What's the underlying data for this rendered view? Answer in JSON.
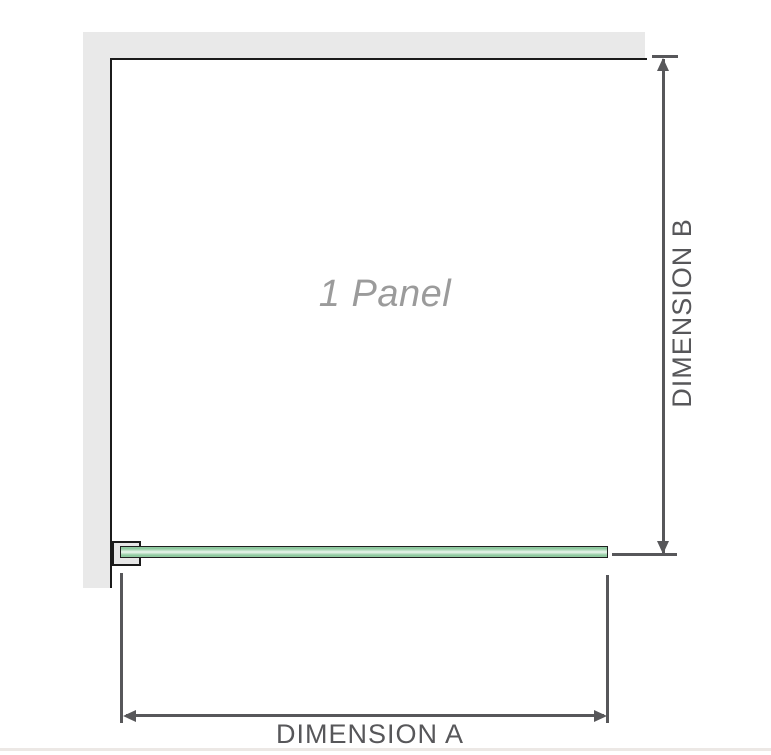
{
  "diagram": {
    "panel_label": "1 Panel",
    "dimension_a_label": "DIMENSION A",
    "dimension_b_label": "DIMENSION B"
  },
  "colors": {
    "wall": "#e9e9e9",
    "outline": "#1b1b1b",
    "dim": "#57575a",
    "panel-label": "#9b9b9b",
    "glass-border": "#1f1f1f",
    "glass-edge": "#8fcaa0",
    "glass-mid": "#edf7ef",
    "bracket-gap": "#e7e7e7",
    "bottom-line": "#ece8e5"
  }
}
